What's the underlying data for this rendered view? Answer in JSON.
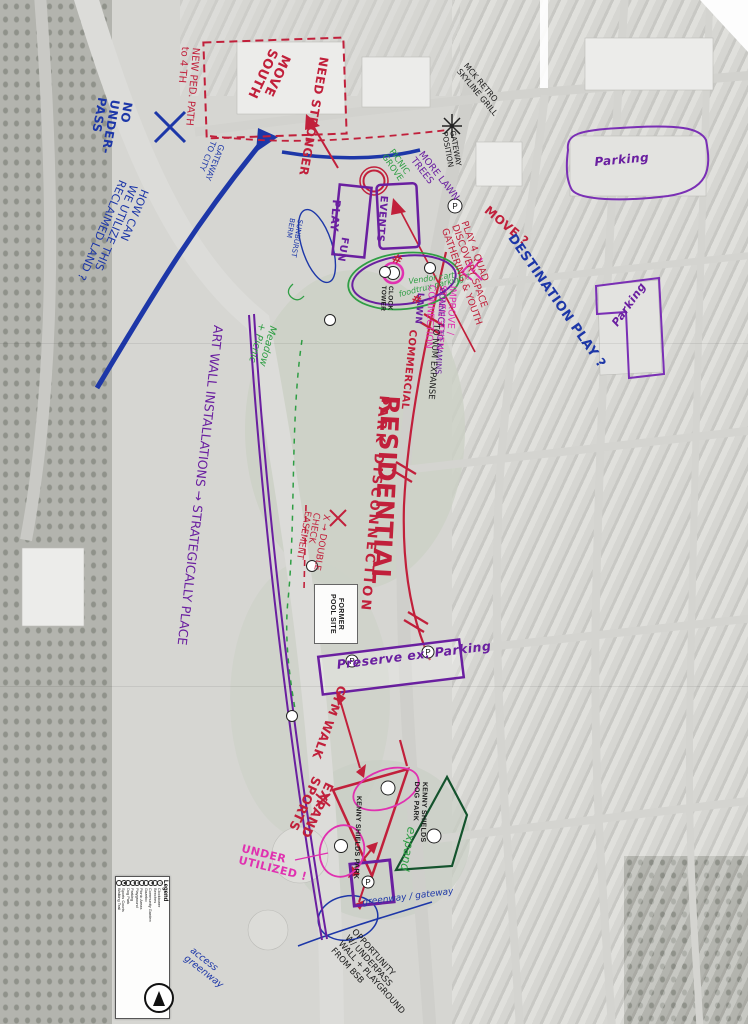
{
  "ink_colors": {
    "red": "#c1203b",
    "blue": "#1d37a8",
    "purple": "#6a1fa0",
    "green": "#2f9e44",
    "dark_green": "#14532d",
    "pink": "#e031b0",
    "black": "#1a1a1a"
  },
  "legend": {
    "title": "Legend",
    "items": [
      {
        "label": "Clocktower",
        "icon": "clocktower-icon",
        "glyph": "◷"
      },
      {
        "label": "Benches",
        "icon": "bench-icon",
        "glyph": "≡"
      },
      {
        "label": "Community Garden",
        "icon": "garden-icon",
        "glyph": "✿"
      },
      {
        "label": "Gazebo",
        "icon": "gazebo-icon",
        "glyph": "⌂"
      },
      {
        "label": "Picnic Areas",
        "icon": "picnic-icon",
        "glyph": "☂"
      },
      {
        "label": "Playground",
        "icon": "playground-icon",
        "glyph": "▲"
      },
      {
        "label": "Parking",
        "icon": "parking-icon",
        "glyph": "P"
      },
      {
        "label": "Dog Park",
        "icon": "dog-park-icon",
        "glyph": "⚑"
      },
      {
        "label": "Sports Courts",
        "icon": "sports-courts-icon",
        "glyph": "●"
      },
      {
        "label": "Walking Trail",
        "icon": "walking-trail-icon",
        "glyph": "╌"
      }
    ]
  },
  "compass": {
    "name": "north-arrow"
  },
  "printed_labels": {
    "former_pool_site": "FORMER\nPOOL SITE",
    "kenny_shields_park": "KENNY SHIELDS PARK",
    "kenny_shields_dog_park": "KENNY SHIELDS\nDOG PARK",
    "clock_tower": "CLOCK\nTOWER"
  },
  "icon_glyphs": {
    "parking": "P"
  },
  "annotations": {
    "no_underpass": {
      "text": "NO\nUNDER-\nPASS"
    },
    "how_can": {
      "text": "HOW CAN\nWE UTILIZE THIS\nRECLAIMED LAND ?"
    },
    "gateway_to_city": {
      "text": "GATEWAY\nTO CITY"
    },
    "new_ped_path": {
      "text": "NEW PED. PATH\nto 4 TH"
    },
    "move_south": {
      "text": "MOVE\nSOUTH"
    },
    "need_stronger": {
      "text": "NEED STRONGER"
    },
    "mck_grill": {
      "text": "MCK RETRO\nSKYLINE GRILL"
    },
    "gateway_position": {
      "text": "GATEWAY\nPOSITION"
    },
    "picnic_grove": {
      "text": "PICNIC\nGROVE"
    },
    "more_lawn_trees": {
      "text": "MORE LAWN\nTREES"
    },
    "play": {
      "text": "PLAY"
    },
    "fun": {
      "text": "FUN"
    },
    "events": {
      "text": "EVENTS"
    },
    "sunburst_berm": {
      "text": "SUNBURST\nBERM"
    },
    "vendor_cart": {
      "text": "Vendor cart"
    },
    "foodtrux": {
      "text": "foodtrux parking ?"
    },
    "lawn": {
      "text": "LAWN"
    },
    "move_q": {
      "text": "MOVE ?"
    },
    "play_quad": {
      "text": "PLAY 4 QUAD\nDISCOVERY SPACE\nGATHERING & YOUTH"
    },
    "destination_play": {
      "text": "DESTINATION PLAY ?"
    },
    "improve_connection": {
      "text": "IMPROVE /\nSTRENGTHEN\nCONNECTION"
    },
    "connect_kamins": {
      "text": "CONNECT TO KAMINS"
    },
    "commercial": {
      "text": "COMMERCIAL"
    },
    "to_num_expanse": {
      "text": "TO NUM EXPANSE"
    },
    "residential": {
      "text": "RESIDENTIAL"
    },
    "park_disconnection": {
      "text": "PARK DISCONNECTION"
    },
    "art_wall": {
      "text": "ART WALL INSTALLATIONS → STRATEGICALLY PLACE"
    },
    "meadow_picnic": {
      "text": "Meadow\n+ Picnic"
    },
    "double_check": {
      "text": "X → DOUBLE\nCHECK\nEASEMENT"
    },
    "preserve_parking": {
      "text": "Preserve ex. Parking"
    },
    "gym_walk": {
      "text": "GYM WALK"
    },
    "expand_sports": {
      "text": "EXPAND\nSPORTS"
    },
    "expand": {
      "text": "expand"
    },
    "under_utilized": {
      "text": "UNDER\nUTILIZED !"
    },
    "opportunity": {
      "text": "OPPORTUNITY\nW/ UNDERPASS\nWALL + PLAYGROUND\nFROM BSB"
    },
    "greenway_gateway": {
      "text": "greenway / gateway"
    },
    "access_greenway": {
      "text": "access\ngreenway"
    },
    "parking_lot_1": {
      "text": "Parking"
    },
    "parking_lot_2": {
      "text": "Parking"
    },
    "hash_1": {
      "text": "#"
    },
    "hash_2": {
      "text": "#"
    }
  }
}
